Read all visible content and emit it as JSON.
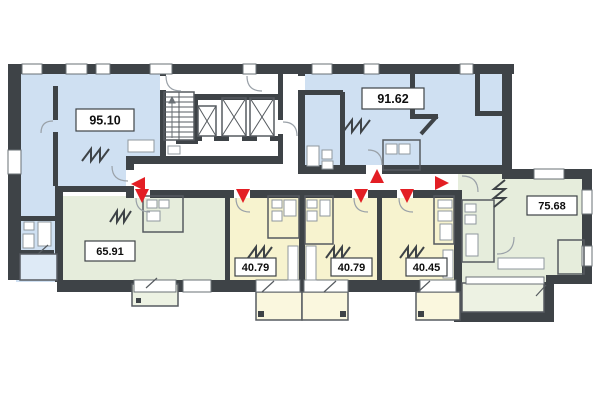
{
  "document": {
    "kind": "residential floor plan"
  },
  "units": [
    {
      "id": "apt-95",
      "area_m2": "95.10",
      "fill": "blue"
    },
    {
      "id": "apt-91",
      "area_m2": "91.62",
      "fill": "blue"
    },
    {
      "id": "apt-65",
      "area_m2": "65.91",
      "fill": "green"
    },
    {
      "id": "apt-40a",
      "area_m2": "40.79",
      "fill": "yellow"
    },
    {
      "id": "apt-40b",
      "area_m2": "40.79",
      "fill": "yellow"
    },
    {
      "id": "apt-40c",
      "area_m2": "40.45",
      "fill": "yellow"
    },
    {
      "id": "apt-75",
      "area_m2": "75.68",
      "fill": "green"
    }
  ],
  "core": {
    "staircase": true,
    "elevators": 3
  },
  "entrance_arrows": [
    {
      "direction": "left",
      "unit_area": "95.10"
    },
    {
      "direction": "down",
      "unit_area": "65.91"
    },
    {
      "direction": "down",
      "unit_area": "40.79"
    },
    {
      "direction": "up",
      "unit_area": "91.62"
    },
    {
      "direction": "down",
      "unit_area": "40.79"
    },
    {
      "direction": "down",
      "unit_area": "40.45"
    },
    {
      "direction": "right",
      "unit_area": "75.68"
    }
  ],
  "colors": {
    "background": "#FFFFFF",
    "wall": "#3E4347",
    "apartment_blue": "#CFE0F2",
    "apartment_yellow": "#F7F3CF",
    "apartment_green": "#E6EDDC",
    "balcony_blue": "#DEEAF6",
    "balcony_yellow": "#FAF7DE",
    "balcony_green": "#EDF2E3",
    "arrow_red": "#E31E24",
    "thin_line": "#565B60",
    "fixture_line": "#8F979E"
  }
}
